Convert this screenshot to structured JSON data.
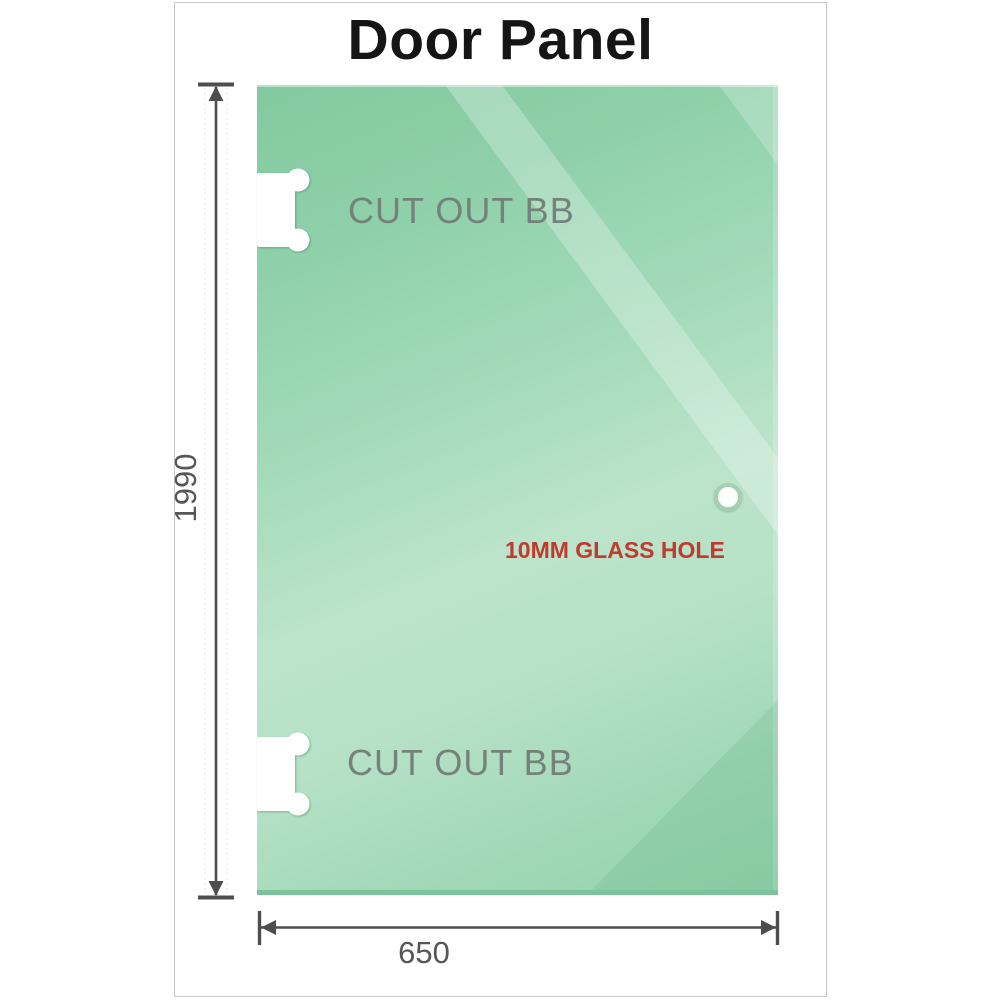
{
  "title": "Door Panel",
  "panel": {
    "cutout_top_label": "CUT OUT BB",
    "cutout_bottom_label": "CUT OUT BB",
    "glass_hole_label": "10MM GLASS HOLE"
  },
  "dimensions": {
    "height_label": "1990",
    "width_label": "650"
  },
  "colors": {
    "glass_base": "#8ecfa8",
    "glass_light": "#bce4cb",
    "glass_bottom_edge": "#7cc29b",
    "cutout_label_text": "#75827a",
    "glass_hole_ring": "#a7ceb5",
    "glass_hole_label_text": "#bf3b2e",
    "dimension_line": "#4d4d4d",
    "dimension_text": "#565656",
    "title_text": "#151515",
    "frame_border": "#c7c7c7"
  }
}
